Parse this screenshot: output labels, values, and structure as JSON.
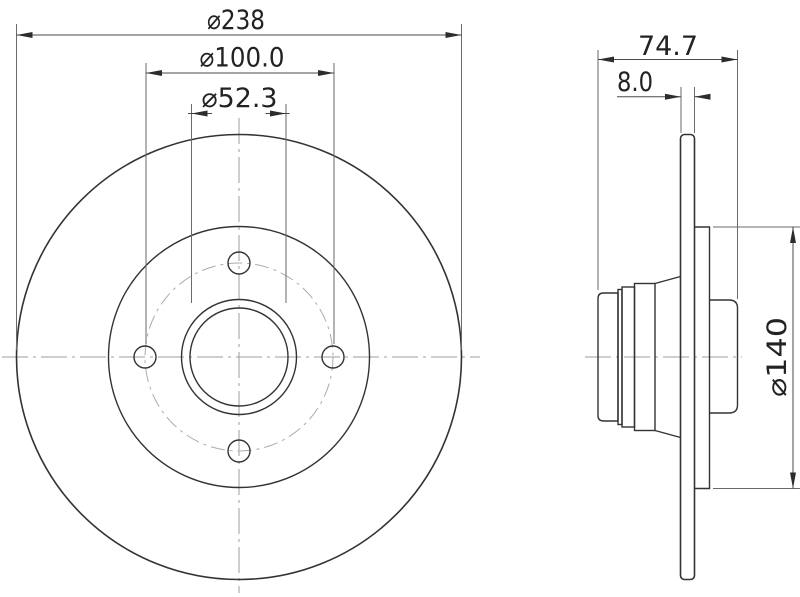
{
  "style": {
    "background": "#ffffff",
    "outline_color": "#333333",
    "dimension_color": "#4a4a4a",
    "centerline_color": "#9e9e9e"
  },
  "front_view": {
    "name": "front-view",
    "bolt_hole_count": 4,
    "dimensions": {
      "outer_diameter": "⌀238",
      "bolt_circle_diameter": "⌀100.0",
      "center_bore_diameter": "⌀52.3"
    }
  },
  "side_view": {
    "name": "side-view",
    "dimensions": {
      "total_width": "74.7",
      "disc_thickness": "8.0",
      "hat_diameter": "⌀140"
    }
  }
}
